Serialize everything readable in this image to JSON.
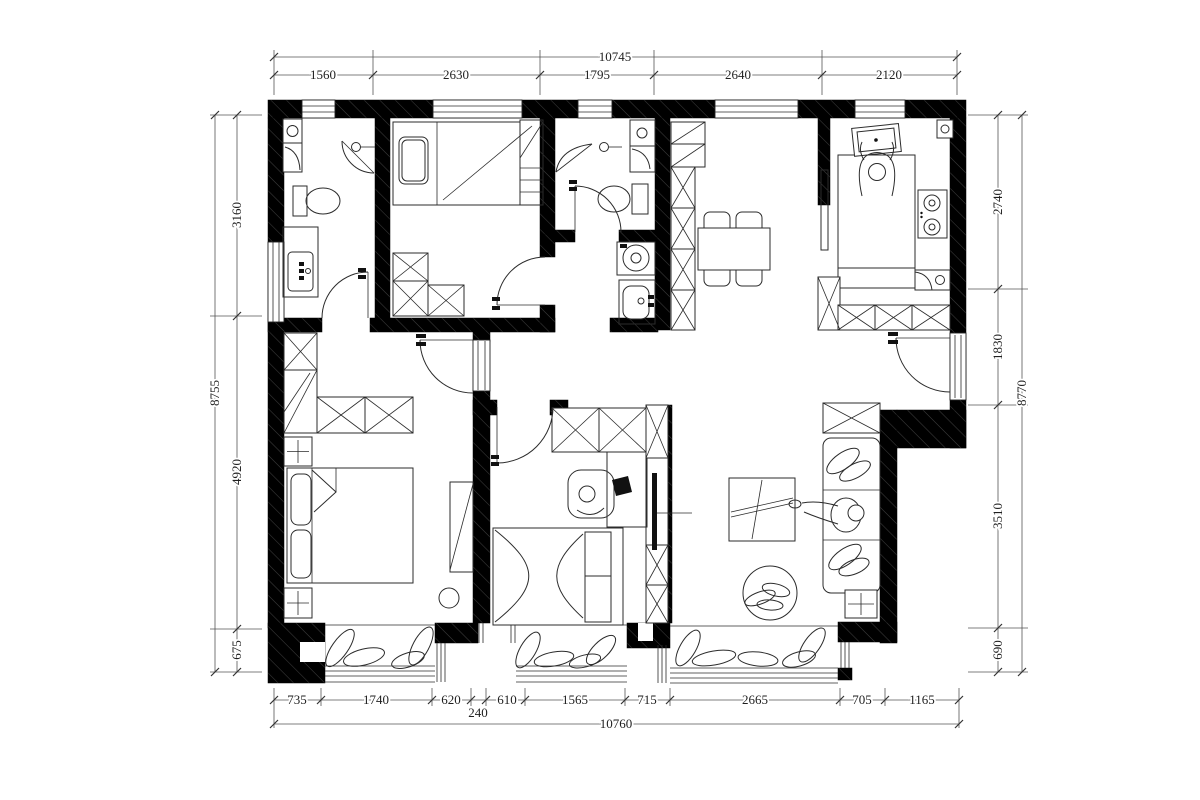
{
  "dimensions": {
    "top": {
      "total": "10745",
      "segments": [
        "1560",
        "2630",
        "1795",
        "2640",
        "2120"
      ]
    },
    "bottom": {
      "total": "10760",
      "segments": [
        "735",
        "1740",
        "620",
        "240",
        "610",
        "1565",
        "715",
        "2665",
        "705",
        "1165"
      ]
    },
    "left": {
      "total": "8755",
      "segments": [
        "3160",
        "4920",
        "675"
      ]
    },
    "right": {
      "total": "8770",
      "segments": [
        "2740",
        "1830",
        "3510",
        "690"
      ]
    }
  },
  "colors": {
    "wall": "#000000",
    "wall_hatch": "#3d3d3d",
    "furniture_line": "#2b2b2b",
    "dimension_line": "#555555",
    "dimension_text": "#1f1f1f",
    "background": "#ffffff"
  }
}
